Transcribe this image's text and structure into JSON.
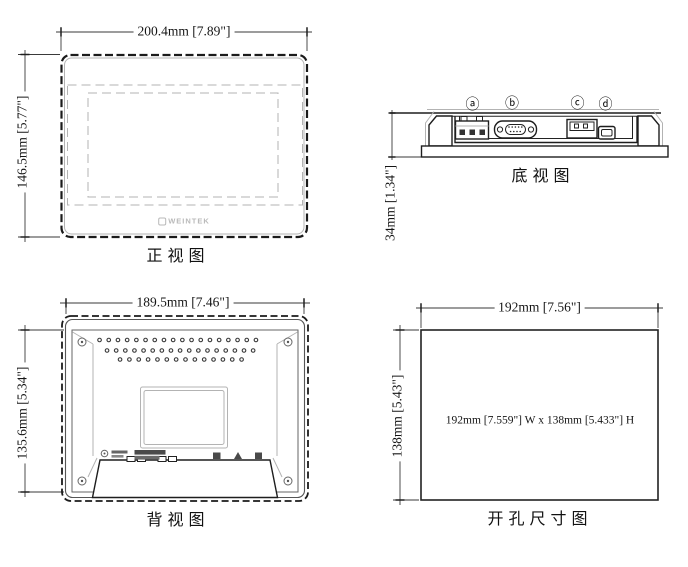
{
  "front_view": {
    "caption": "正视图",
    "width_dim": "200.4mm [7.89\"]",
    "height_dim": "146.5mm [5.77\"]",
    "logo_text": "WEINTEK"
  },
  "bottom_view": {
    "caption": "底视图",
    "height_dim": "34mm [1.34\"]",
    "port_labels": [
      "ⓐ",
      "ⓑ",
      "ⓒ",
      "ⓓ"
    ]
  },
  "rear_view": {
    "caption": "背视图",
    "width_dim": "189.5mm [7.46\"]",
    "height_dim": "135.6mm [5.34\"]"
  },
  "cutout_view": {
    "caption": "开孔尺寸图",
    "width_dim": "192mm [7.56\"]",
    "height_dim": "138mm [5.43\"]",
    "center_note": "192mm [7.559\"] W x 138mm [5.433\"] H"
  },
  "colors": {
    "line": "#222222",
    "light_line": "#b3b3b3",
    "background": "#ffffff"
  }
}
